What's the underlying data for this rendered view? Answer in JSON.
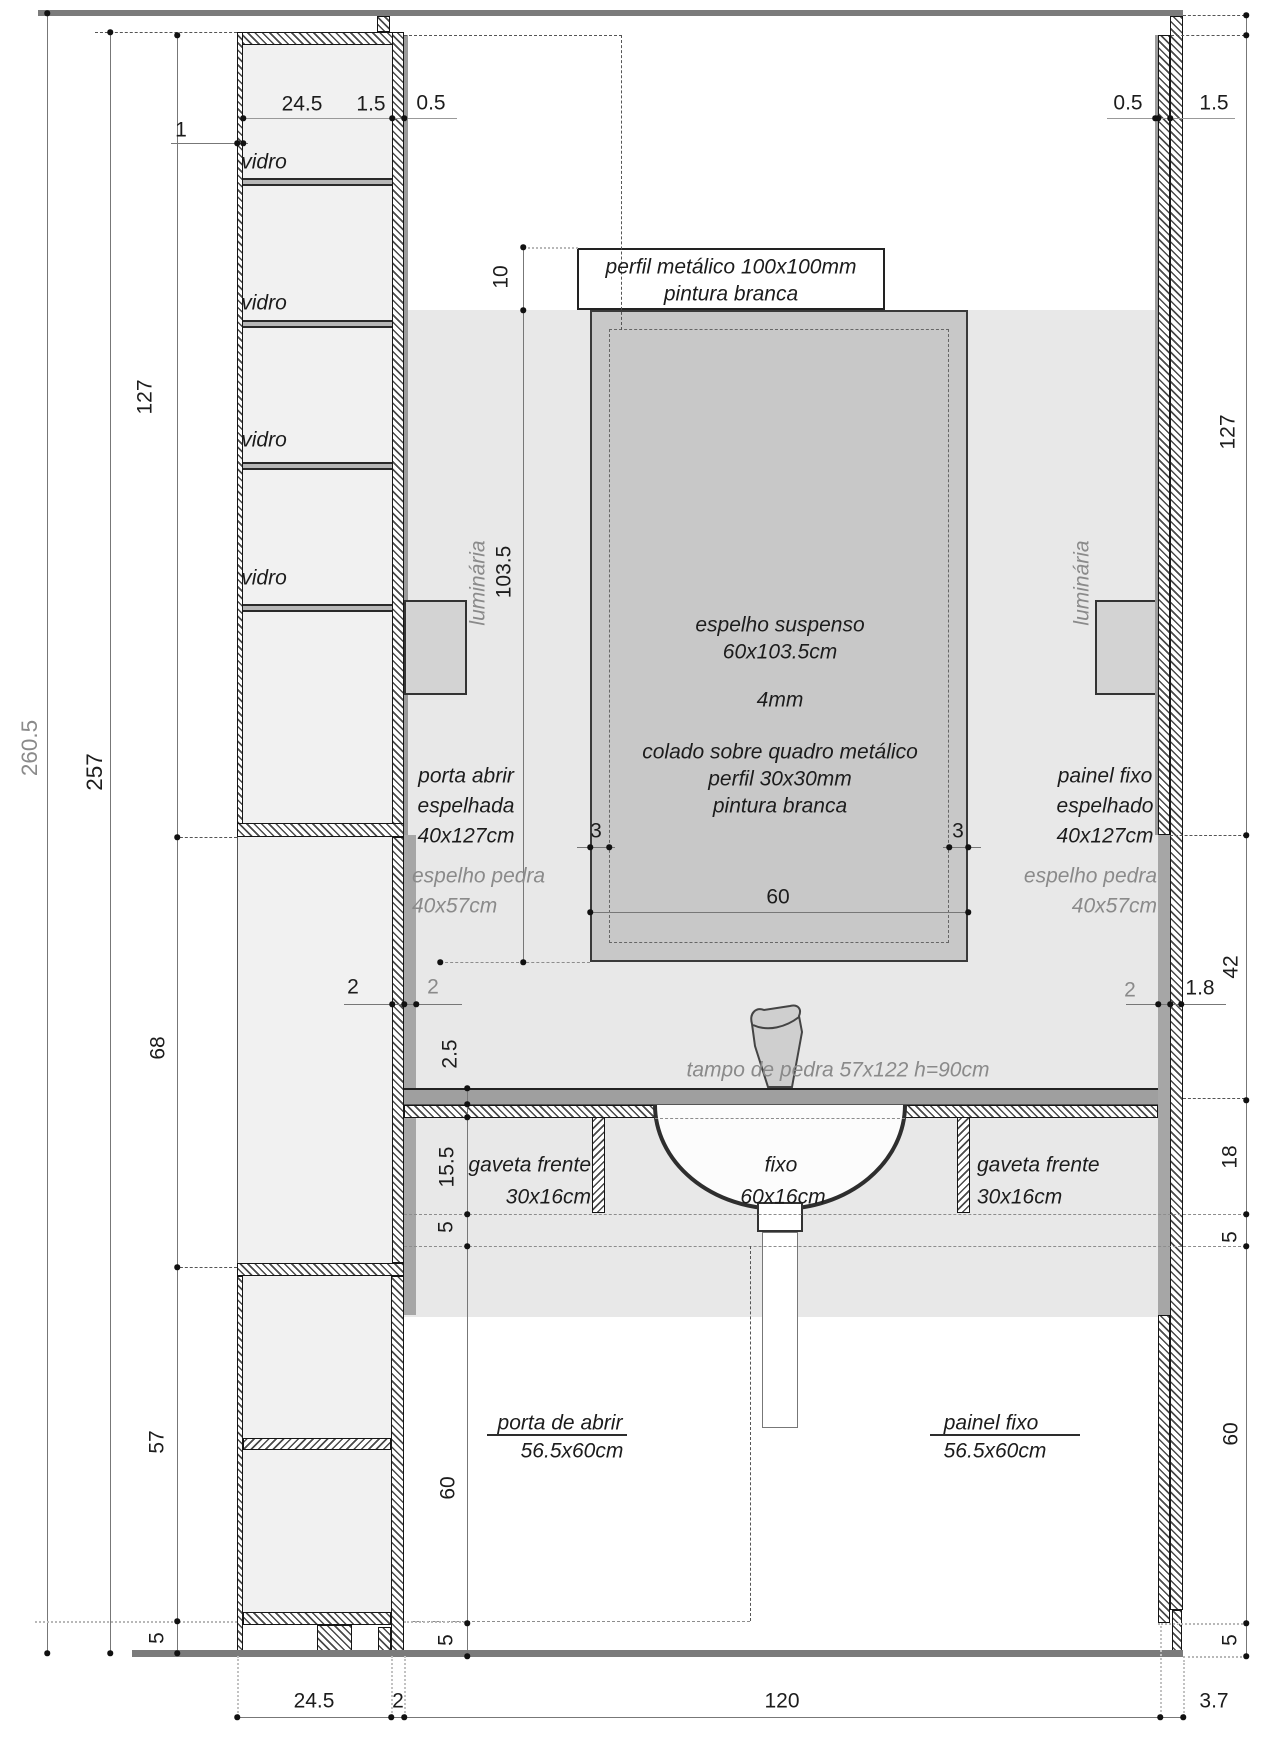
{
  "drawing_type": "architectural bathroom vanity section / elevation",
  "colors": {
    "wall_background": "#e8e8e8",
    "mirror_fill": "#c8c8c8",
    "stone_strip": "#a6a6a6",
    "counter_stone": "#9f9f9f",
    "fixture_fill": "#d3d3d3",
    "cabinet_interior": "#f1f1f1",
    "structure_grey": "#7b7b7b",
    "dim_text": "#1c1c1c",
    "dim_text_grey": "#8a8a8a"
  },
  "dims": {
    "total_height": "260.5",
    "wall_height": "257",
    "left_upper": "127",
    "left_mid": "68",
    "left_lower": "57",
    "left_plinth": "5",
    "cab_inner_w": "24.5",
    "cab_wall_right": "1.5",
    "cab_gap": "0.5",
    "cab_wall_left": "1",
    "profile_height": "10",
    "mirror_height": "103.5",
    "frame_inset_left": "3",
    "frame_inset_right": "3",
    "mirror_width": "60",
    "wall_thick": "2",
    "stone_thick": "2",
    "counter_thick": "2.5",
    "drawer_front": "15.5",
    "recess": "5",
    "door_height": "60",
    "center_plinth": "5",
    "right_gap": "0.5",
    "right_panel_thick": "1.5",
    "right_mirror_panel": "127",
    "right_backsplash": "42",
    "right_stone_thick": "2",
    "right_wall_thick": "1.8",
    "right_drawer": "18",
    "right_recess": "5",
    "right_open": "60",
    "right_plinth": "5",
    "bottom_cabinet": "24.5",
    "bottom_wall": "2",
    "bottom_vanity": "120",
    "bottom_panel": "3.7"
  },
  "labels": {
    "glass_shelf": "vidro",
    "profile_line1": "perfil metálico 100x100mm",
    "profile_line2": "pintura branca",
    "mirror_line1": "espelho suspenso",
    "mirror_line2": "60x103.5cm",
    "mirror_line3": "4mm",
    "mirror_line4": "colado sobre quadro metálico",
    "mirror_line5": "perfil 30x30mm",
    "mirror_line6": "pintura branca",
    "light": "luminária",
    "left_door_line1": "porta abrir",
    "left_door_line2": "espelhada",
    "left_door_line3": "40x127cm",
    "stone_mirror_line1": "espelho pedra",
    "stone_mirror_line2": "40x57cm",
    "right_panel_line1": "painel fixo",
    "right_panel_line2": "espelhado",
    "right_panel_line3": "40x127cm",
    "countertop": "tampo de pedra 57x122 h=90cm",
    "drawer_line1": "gaveta frente",
    "drawer_line2": "30x16cm",
    "fixed_line1": "fixo",
    "fixed_line2": "60x16cm",
    "bottom_door_line1": "porta de abrir",
    "bottom_size": "56.5x60cm",
    "bottom_panel_line1": "painel fixo"
  }
}
